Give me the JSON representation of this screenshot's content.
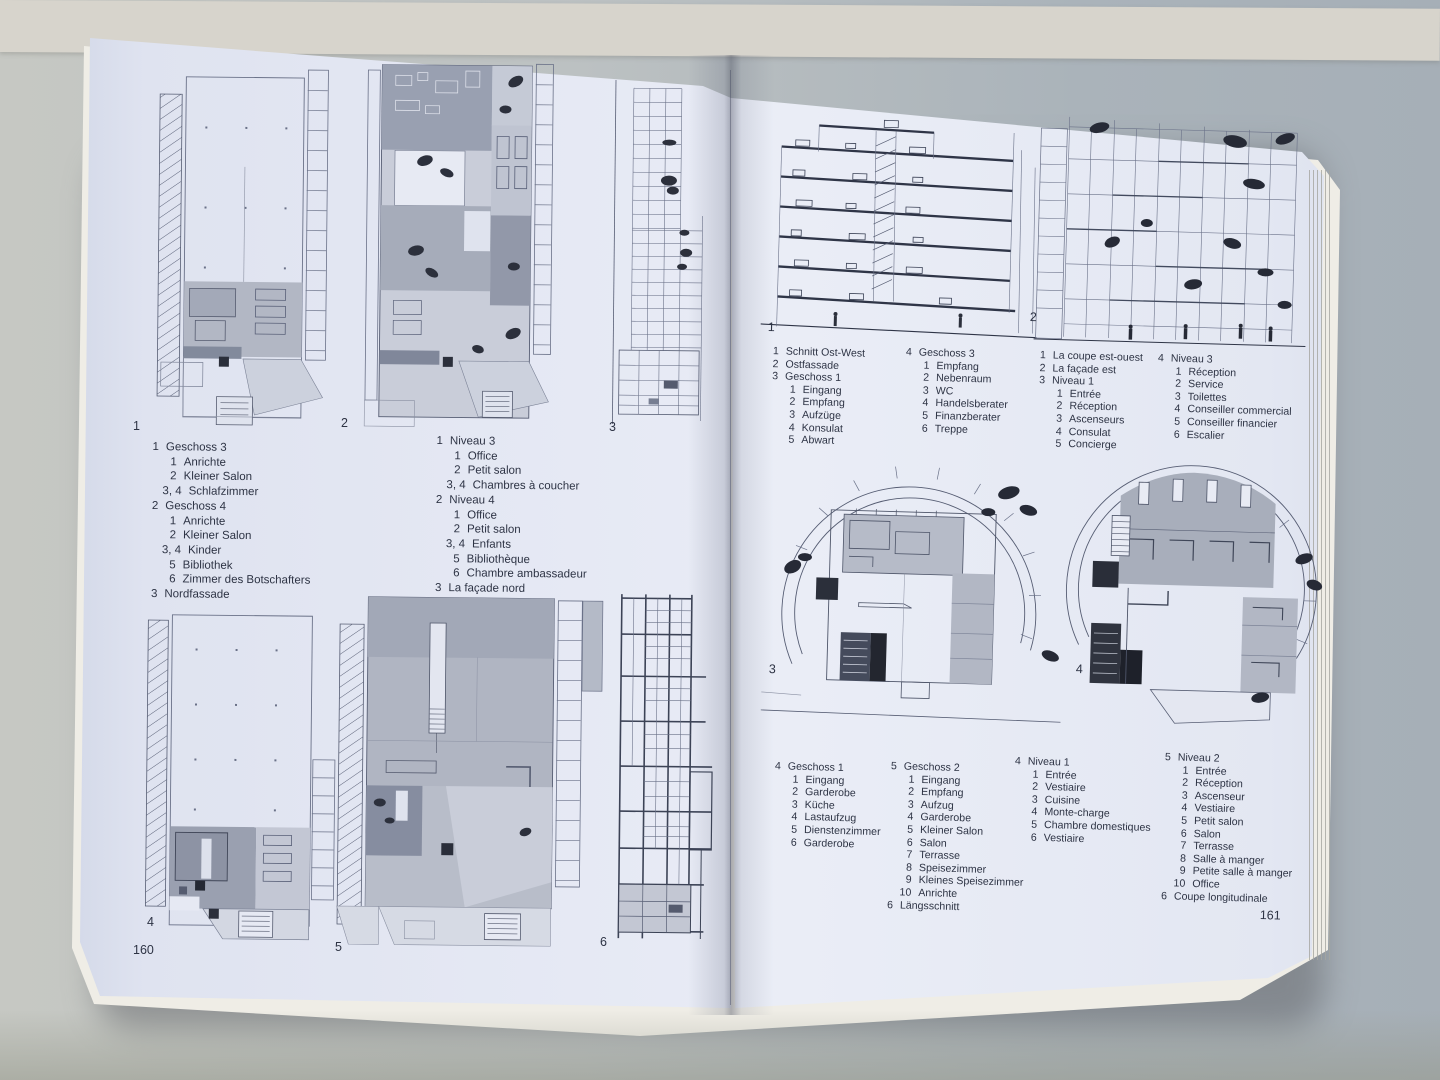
{
  "colors": {
    "paper_tint": "#e9ecf6",
    "ink": "#454c60",
    "background_wall": "#d7d4cc",
    "background_table": "#aab3ba",
    "plan_gray_light": "#c5cad6",
    "plan_gray_mid": "#a6acba",
    "plan_gray_dark": "#8d93a4",
    "plan_black": "#2b2f3b"
  },
  "book": {
    "left_page": {
      "page_number": "160",
      "figure_labels": [
        "1",
        "2",
        "3",
        "4",
        "5",
        "6"
      ],
      "captions_de": {
        "lines": [
          {
            "n": "1",
            "t": "Geschoss 3",
            "i": 0
          },
          {
            "n": "1",
            "t": "Anrichte",
            "i": 1
          },
          {
            "n": "2",
            "t": "Kleiner Salon",
            "i": 1
          },
          {
            "n": "3, 4",
            "t": "Schlafzimmer",
            "i": 1
          },
          {
            "n": "2",
            "t": "Geschoss 4",
            "i": 0
          },
          {
            "n": "1",
            "t": "Anrichte",
            "i": 1
          },
          {
            "n": "2",
            "t": "Kleiner Salon",
            "i": 1
          },
          {
            "n": "3, 4",
            "t": "Kinder",
            "i": 1
          },
          {
            "n": "5",
            "t": "Bibliothek",
            "i": 1
          },
          {
            "n": "6",
            "t": "Zimmer des Botschafters",
            "i": 1
          },
          {
            "n": "3",
            "t": "Nordfassade",
            "i": 0
          }
        ]
      },
      "captions_fr": {
        "lines": [
          {
            "n": "1",
            "t": "Niveau 3",
            "i": 0
          },
          {
            "n": "1",
            "t": "Office",
            "i": 1
          },
          {
            "n": "2",
            "t": "Petit salon",
            "i": 1
          },
          {
            "n": "3, 4",
            "t": "Chambres à coucher",
            "i": 1
          },
          {
            "n": "2",
            "t": "Niveau 4",
            "i": 0
          },
          {
            "n": "1",
            "t": "Office",
            "i": 1
          },
          {
            "n": "2",
            "t": "Petit salon",
            "i": 1
          },
          {
            "n": "3, 4",
            "t": "Enfants",
            "i": 1
          },
          {
            "n": "5",
            "t": "Bibliothèque",
            "i": 1
          },
          {
            "n": "6",
            "t": "Chambre ambassadeur",
            "i": 1
          },
          {
            "n": "3",
            "t": "La façade nord",
            "i": 0
          }
        ]
      }
    },
    "right_page": {
      "page_number": "161",
      "figure_labels": [
        "1",
        "2",
        "3",
        "4"
      ],
      "captions_top_de_a": {
        "lines": [
          {
            "n": "1",
            "t": "Schnitt Ost-West",
            "i": 0
          },
          {
            "n": "2",
            "t": "Ostfassade",
            "i": 0
          },
          {
            "n": "3",
            "t": "Geschoss 1",
            "i": 0
          },
          {
            "n": "1",
            "t": "Eingang",
            "i": 1
          },
          {
            "n": "2",
            "t": "Empfang",
            "i": 1
          },
          {
            "n": "3",
            "t": "Aufzüge",
            "i": 1
          },
          {
            "n": "4",
            "t": "Konsulat",
            "i": 1
          },
          {
            "n": "5",
            "t": "Abwart",
            "i": 1
          }
        ]
      },
      "captions_top_de_b": {
        "lines": [
          {
            "n": "4",
            "t": "Geschoss 3",
            "i": 0
          },
          {
            "n": "1",
            "t": "Empfang",
            "i": 1
          },
          {
            "n": "2",
            "t": "Nebenraum",
            "i": 1
          },
          {
            "n": "3",
            "t": "WC",
            "i": 1
          },
          {
            "n": "4",
            "t": "Handelsberater",
            "i": 1
          },
          {
            "n": "5",
            "t": "Finanzberater",
            "i": 1
          },
          {
            "n": "6",
            "t": "Treppe",
            "i": 1
          }
        ]
      },
      "captions_top_fr_a": {
        "lines": [
          {
            "n": "1",
            "t": "La coupe est-ouest",
            "i": 0
          },
          {
            "n": "2",
            "t": "La façade est",
            "i": 0
          },
          {
            "n": "3",
            "t": "Niveau 1",
            "i": 0
          },
          {
            "n": "1",
            "t": "Entrée",
            "i": 1
          },
          {
            "n": "2",
            "t": "Réception",
            "i": 1
          },
          {
            "n": "3",
            "t": "Ascenseurs",
            "i": 1
          },
          {
            "n": "4",
            "t": "Consulat",
            "i": 1
          },
          {
            "n": "5",
            "t": "Concierge",
            "i": 1
          }
        ]
      },
      "captions_top_fr_b": {
        "lines": [
          {
            "n": "4",
            "t": "Niveau 3",
            "i": 0
          },
          {
            "n": "1",
            "t": "Réception",
            "i": 1
          },
          {
            "n": "2",
            "t": "Service",
            "i": 1
          },
          {
            "n": "3",
            "t": "Toilettes",
            "i": 1
          },
          {
            "n": "4",
            "t": "Conseiller commercial",
            "i": 1
          },
          {
            "n": "5",
            "t": "Conseiller financier",
            "i": 1
          },
          {
            "n": "6",
            "t": "Escalier",
            "i": 1
          }
        ]
      },
      "captions_bottom_de_a": {
        "lines": [
          {
            "n": "4",
            "t": "Geschoss 1",
            "i": 0
          },
          {
            "n": "1",
            "t": "Eingang",
            "i": 1
          },
          {
            "n": "2",
            "t": "Garderobe",
            "i": 1
          },
          {
            "n": "3",
            "t": "Küche",
            "i": 1
          },
          {
            "n": "4",
            "t": "Lastaufzug",
            "i": 1
          },
          {
            "n": "5",
            "t": "Dienstenzimmer",
            "i": 1
          },
          {
            "n": "6",
            "t": "Garderobe",
            "i": 1
          }
        ]
      },
      "captions_bottom_de_b": {
        "lines": [
          {
            "n": "5",
            "t": "Geschoss 2",
            "i": 0
          },
          {
            "n": "1",
            "t": "Eingang",
            "i": 1
          },
          {
            "n": "2",
            "t": "Empfang",
            "i": 1
          },
          {
            "n": "3",
            "t": "Aufzug",
            "i": 1
          },
          {
            "n": "4",
            "t": "Garderobe",
            "i": 1
          },
          {
            "n": "5",
            "t": "Kleiner Salon",
            "i": 1
          },
          {
            "n": "6",
            "t": "Salon",
            "i": 1
          },
          {
            "n": "7",
            "t": "Terrasse",
            "i": 1
          },
          {
            "n": "8",
            "t": "Speisezimmer",
            "i": 1
          },
          {
            "n": "9",
            "t": "Kleines Speisezimmer",
            "i": 1
          },
          {
            "n": "10",
            "t": "Anrichte",
            "i": 1
          },
          {
            "n": "6",
            "t": "Längsschnitt",
            "i": 0
          }
        ]
      },
      "captions_bottom_fr_a": {
        "lines": [
          {
            "n": "4",
            "t": "Niveau 1",
            "i": 0
          },
          {
            "n": "1",
            "t": "Entrée",
            "i": 1
          },
          {
            "n": "2",
            "t": "Vestiaire",
            "i": 1
          },
          {
            "n": "3",
            "t": "Cuisine",
            "i": 1
          },
          {
            "n": "4",
            "t": "Monte-charge",
            "i": 1
          },
          {
            "n": "5",
            "t": "Chambre domestiques",
            "i": 1
          },
          {
            "n": "6",
            "t": "Vestiaire",
            "i": 1
          }
        ]
      },
      "captions_bottom_fr_b": {
        "lines": [
          {
            "n": "5",
            "t": "Niveau 2",
            "i": 0
          },
          {
            "n": "1",
            "t": "Entrée",
            "i": 1
          },
          {
            "n": "2",
            "t": "Réception",
            "i": 1
          },
          {
            "n": "3",
            "t": "Ascenseur",
            "i": 1
          },
          {
            "n": "4",
            "t": "Vestiaire",
            "i": 1
          },
          {
            "n": "5",
            "t": "Petit salon",
            "i": 1
          },
          {
            "n": "6",
            "t": "Salon",
            "i": 1
          },
          {
            "n": "7",
            "t": "Terrasse",
            "i": 1
          },
          {
            "n": "8",
            "t": "Salle à manger",
            "i": 1
          },
          {
            "n": "9",
            "t": "Petite salle à manger",
            "i": 1
          },
          {
            "n": "10",
            "t": "Office",
            "i": 1
          },
          {
            "n": "6",
            "t": "Coupe longitudinale",
            "i": 0
          }
        ]
      }
    }
  }
}
